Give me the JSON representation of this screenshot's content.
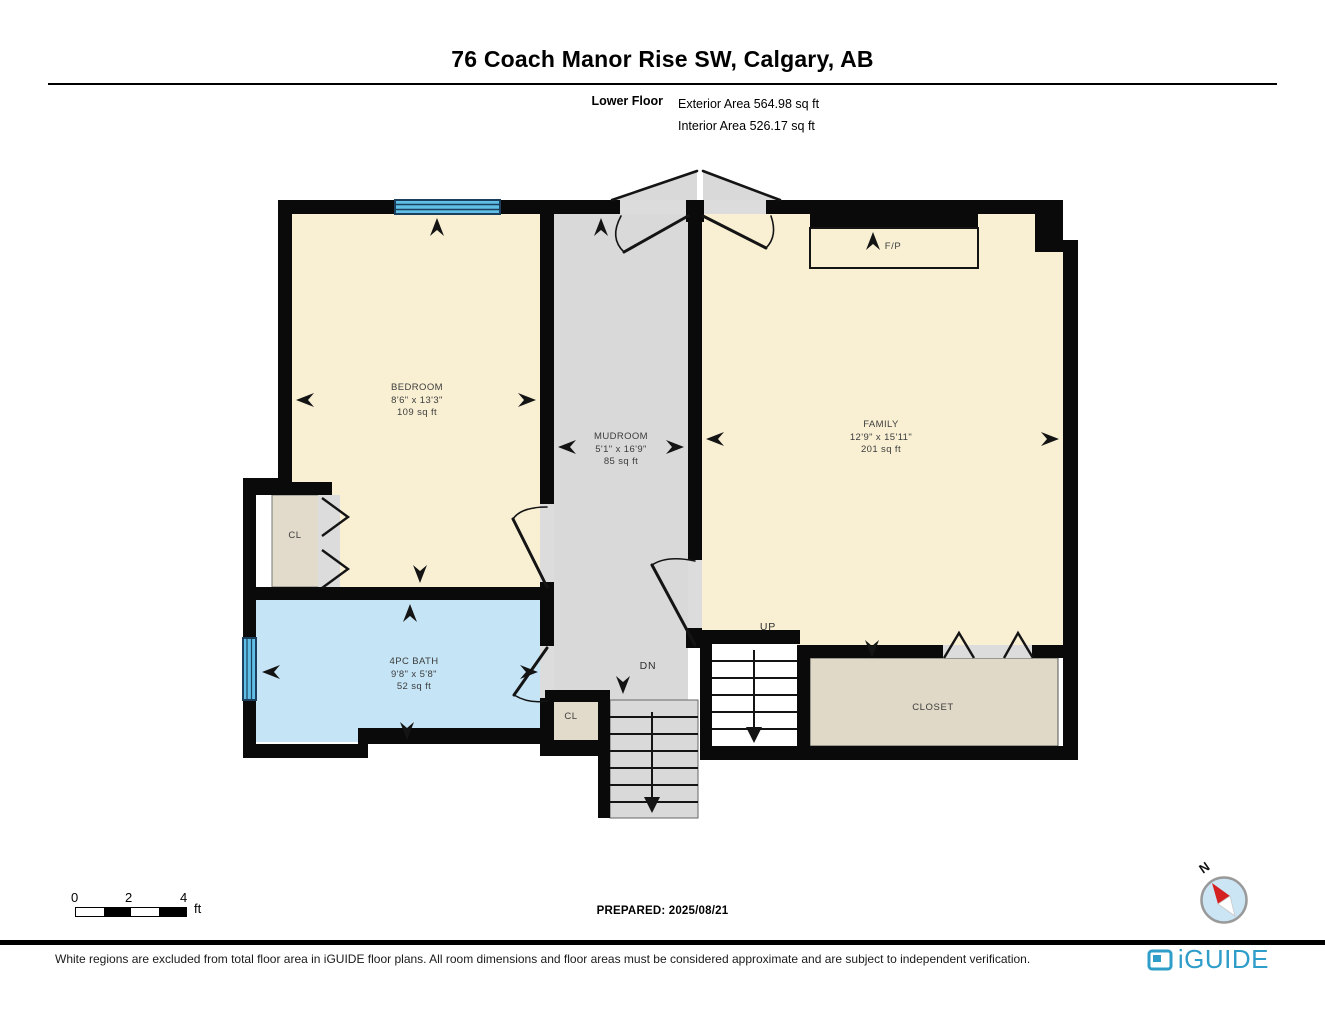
{
  "header": {
    "title": "76 Coach Manor Rise SW, Calgary, AB",
    "floor_label": "Lower Floor",
    "exterior_area": "Exterior Area 564.98 sq ft",
    "interior_area": "Interior Area 526.17 sq ft"
  },
  "rooms": {
    "bedroom": {
      "name": "BEDROOM",
      "dims": "8'6\" x 13'3\"",
      "area": "109 sq ft"
    },
    "mudroom": {
      "name": "MUDROOM",
      "dims": "5'1\" x 16'9\"",
      "area": "85 sq ft"
    },
    "family": {
      "name": "FAMILY",
      "dims": "12'9\" x 15'11\"",
      "area": "201 sq ft"
    },
    "bath": {
      "name": "4PC BATH",
      "dims": "9'8\" x 5'8\"",
      "area": "52 sq ft"
    },
    "closet": {
      "name": "CLOSET"
    },
    "bedroom_closet": {
      "name": "CL"
    },
    "stair_closet": {
      "name": "CL"
    },
    "fireplace": {
      "name": "F/P"
    },
    "stairs_up": {
      "name": "UP"
    },
    "stairs_down": {
      "name": "DN"
    }
  },
  "scale_bar": {
    "tick_0": "0",
    "tick_1": "2",
    "tick_2": "4",
    "unit": "ft"
  },
  "prepared_label": "PREPARED: 2025/08/21",
  "compass": {
    "north_label": "N"
  },
  "footer": {
    "disclaimer": "White regions are excluded from total floor area in iGUIDE floor plans. All room dimensions and floor areas must be considered approximate and are subject to independent verification.",
    "brand": "iGUIDE"
  },
  "colors": {
    "brand_teal": "#2E9DC9",
    "room_cream": "#F9F0D4",
    "room_gray": "#D9D9D9",
    "room_tan": "#E0D9C8",
    "bath_blue": "#C5E5F6",
    "window_blue": "#5FBFE6",
    "wall_black": "#0A0A0A"
  }
}
